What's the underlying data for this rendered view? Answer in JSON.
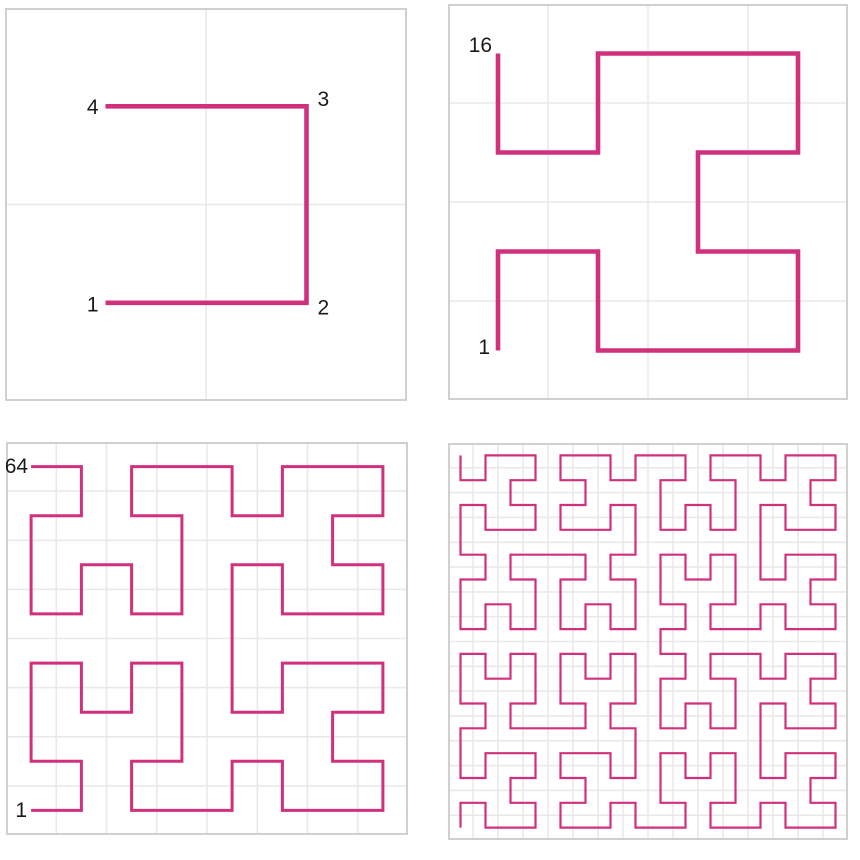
{
  "figure": {
    "description": "Hilbert curve iterations, orders 1 to 4",
    "curve": {
      "type": "hilbert",
      "color": "#d1307c",
      "start_corner": "bottom-left",
      "end_corner": "top-left",
      "variant": "transposed-d2xy"
    },
    "style": {
      "background": "#ffffff",
      "panel_border_color": "#d0d0d0",
      "panel_border_width": 2,
      "gridline_color": "#e9e9e9",
      "gridline_width": 1.6,
      "label_color": "#1a1a1a",
      "label_font_size": 21
    },
    "panels": [
      {
        "id": "order-1",
        "order": 1,
        "grid": 2,
        "point_count": 4,
        "stroke_width": 4.6,
        "labels": [
          {
            "text": "1",
            "point_index": 0,
            "side": "left",
            "dx": -7,
            "dy": 2
          },
          {
            "text": "2",
            "point_index": 1,
            "side": "right",
            "dx": 11,
            "dy": 5
          },
          {
            "text": "3",
            "point_index": 2,
            "side": "right",
            "dx": 11,
            "dy": -7
          },
          {
            "text": "4",
            "point_index": 3,
            "side": "left",
            "dx": -7,
            "dy": 1
          }
        ]
      },
      {
        "id": "order-2",
        "order": 2,
        "grid": 4,
        "point_count": 16,
        "stroke_width": 4.6,
        "labels": [
          {
            "text": "1",
            "point_index": 0,
            "side": "left",
            "dx": -8,
            "dy": -3
          },
          {
            "text": "16",
            "point_index": 15,
            "side": "left",
            "dx": -6,
            "dy": -8
          }
        ]
      },
      {
        "id": "order-3",
        "order": 3,
        "grid": 8,
        "point_count": 64,
        "stroke_width": 3,
        "labels": [
          {
            "text": "1",
            "point_index": 0,
            "side": "left",
            "dx": -4,
            "dy": 0
          },
          {
            "text": "64",
            "point_index": 63,
            "side": "left",
            "dx": -3,
            "dy": 0
          }
        ]
      },
      {
        "id": "order-4",
        "order": 4,
        "grid": 16,
        "point_count": 256,
        "stroke_width": 2.2,
        "labels": []
      }
    ]
  }
}
